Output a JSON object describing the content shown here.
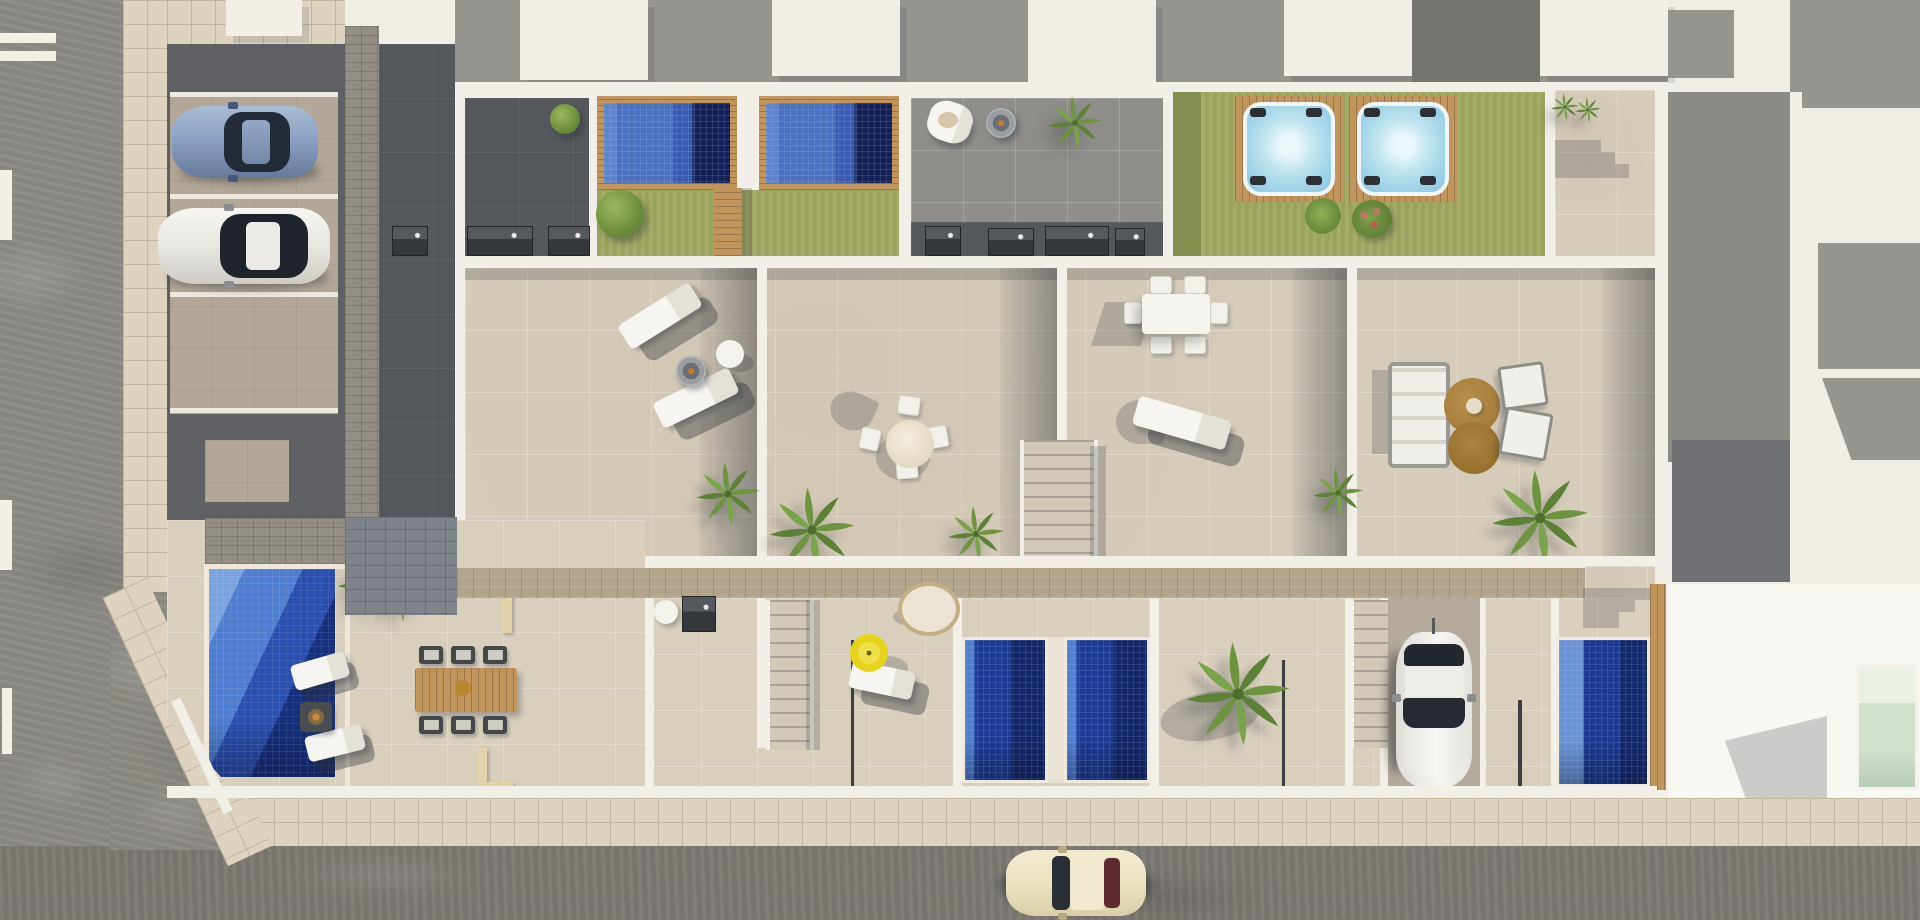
{
  "scene": {
    "title": "Aerial top-down 3D architectural render of a row of four modern townhouses with roof-terrace pools, hot tubs, lower-level plunge pools, landscaped gardens, street-side parking and surrounding streets",
    "type": "architectural-aerial-render",
    "time_of_day": "daytime, strong sun with hard shadows"
  },
  "palette": {
    "road": "#8e8b85",
    "street": "#7d7a74",
    "road_marking": "#f2efe7",
    "sidewalk": "#ddd3bf",
    "sidewalk_line": "#c1b5a0",
    "parking_asphalt": "#5e6064",
    "parking_stall": "#b2a798",
    "stall_line": "#eee9df",
    "paver": "#948f86",
    "paver_dark": "#7f838a",
    "wall_white": "#f2efe8",
    "roof_white": "#efede6",
    "roof_gray": "#97958f",
    "roof_dark": "#74746f",
    "dark_patio": "#54575b",
    "terrace": "#d6ccba",
    "terrace_lower": "#d9cfbd",
    "gray_tile": "#8f8e8a",
    "lawn": "#a1a862",
    "lawn_shade": "#7e8a4d",
    "wood": "#c1955c",
    "walkway": "#b3a58c",
    "pool_light": "#5d83cc",
    "pool_mid": "#3a5cb0",
    "pool_dark": "#1c2f77",
    "gpool_light": "#4f7ed0",
    "gpool_mid": "#1e3c96",
    "gpool_deep": "#13286b",
    "hot_tub": "#bfe4f0",
    "hot_tub_rim": "#f0f6f7",
    "umbrella_yellow": "#e6d41c",
    "rug_brown": "#a67c3b",
    "furniture_white": "#f4f2ec",
    "glass_dark": "#23272f",
    "car_blue": "#8ba2c4",
    "car_white": "#efeeea",
    "car_cream": "#ece3c2",
    "car_rear_window_maroon": "#5e2a31",
    "plant_green": "#6f9440",
    "tree_dark": "#55712f",
    "neighbor_pool_green": "#cfe0cb",
    "shadow": "rgba(44,49,58,0.38)",
    "shadow_soft": "rgba(44,49,58,0.22)"
  },
  "inventory": {
    "vehicles": [
      {
        "name": "blue-hatchback",
        "location": "parking stall, upper left"
      },
      {
        "name": "white-sedan",
        "location": "parking stall, upper left"
      },
      {
        "name": "white-suv",
        "location": "driveway, lower right"
      },
      {
        "name": "cream-classic-car",
        "location": "street, bottom"
      }
    ],
    "water_features": [
      {
        "name": "roof-pool-1",
        "kind": "rooftop pool with wooden deck frame"
      },
      {
        "name": "roof-pool-2",
        "kind": "rooftop pool with wooden deck frame"
      },
      {
        "name": "hot-tub-1",
        "kind": "spa on wooden deck over lawn"
      },
      {
        "name": "hot-tub-2",
        "kind": "spa on wooden deck over lawn"
      },
      {
        "name": "garden-pool-left",
        "kind": "large ground-floor garden pool"
      },
      {
        "name": "plunge-pool-a",
        "kind": "backyard plunge pool"
      },
      {
        "name": "plunge-pool-b",
        "kind": "backyard plunge pool"
      },
      {
        "name": "plunge-pool-right",
        "kind": "backyard plunge pool"
      },
      {
        "name": "neighbor-pool",
        "kind": "pale pool on neighbouring plot"
      }
    ],
    "roof_terraces": [
      {
        "unit": 1,
        "furniture": [
          "two white sun loungers",
          "round fire-bowl table",
          "white side table"
        ]
      },
      {
        "unit": 2,
        "furniture": [
          "round dining table",
          "four white chairs",
          "potted palms"
        ]
      },
      {
        "unit": 3,
        "furniture": [
          "rectangular dining table",
          "six white chairs",
          "white sun lounger"
        ]
      },
      {
        "unit": 4,
        "furniture": [
          "outdoor sofa",
          "two brown round rugs",
          "two armchairs",
          "large palm"
        ]
      }
    ],
    "gardens": [
      {
        "name": "left-garden",
        "items": [
          "garden pool",
          "two loungers",
          "fire table",
          "wooden dining table with six chairs",
          "palms",
          "planter walls"
        ]
      },
      {
        "name": "backyard-umbrella",
        "items": [
          "yellow parasol",
          "white lounger",
          "hanging egg chair",
          "round table",
          "barbecue"
        ]
      },
      {
        "name": "backyard-pools",
        "items": [
          "two plunge pools",
          "palm tree"
        ]
      },
      {
        "name": "backyard-driveway",
        "items": [
          "white SUV",
          "exterior stairs"
        ]
      },
      {
        "name": "backyard-right",
        "items": [
          "plunge pool",
          "wooden gate",
          "stepped shadow"
        ]
      }
    ],
    "landscaping": [
      "olive-green lawns",
      "round clipped tree",
      "ten palm trees",
      "rose bush",
      "green sprig"
    ],
    "infrastructure": [
      "asphalt road left",
      "asphalt street bottom",
      "tiled sidewalks",
      "three parking stalls",
      "paver path",
      "long wooden walkway",
      "three exterior staircases",
      "white parapet roof band",
      "neighbouring roofs"
    ]
  }
}
